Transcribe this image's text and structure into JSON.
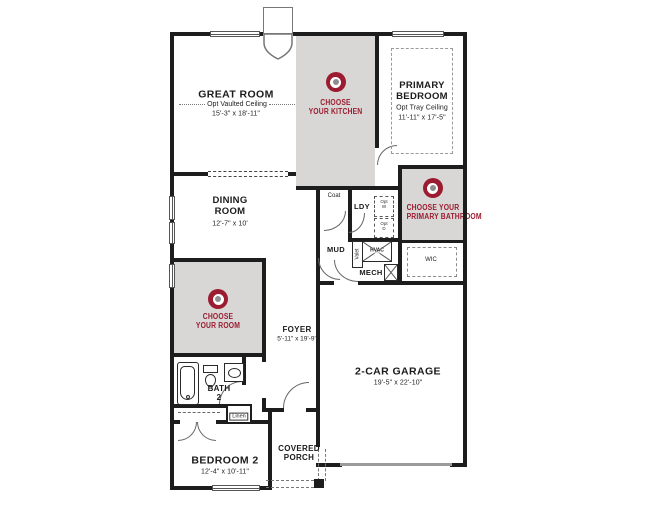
{
  "colors": {
    "accent_red": "#9b1c30",
    "room_highlight": "#d9d6d6",
    "wall": "#1d1d1d"
  },
  "rooms": {
    "great_room": {
      "name": "GREAT ROOM",
      "option": "Opt Vaulted Ceiling",
      "dims": "15'-3\" x 18'-11\""
    },
    "primary_bedroom": {
      "name_line1": "PRIMARY",
      "name_line2": "BEDROOM",
      "option": "Opt Tray Ceiling",
      "dims": "11'-11\" x 17'-5\""
    },
    "dining_room": {
      "name_line1": "DINING",
      "name_line2": "ROOM",
      "dims": "12'-7\" x 10'"
    },
    "foyer": {
      "name": "FOYER",
      "dims": "5'-11\" x 19'-9\""
    },
    "garage": {
      "name": "2-CAR GARAGE",
      "dims": "19'-5\" x 22'-10\""
    },
    "bedroom2": {
      "name": "BEDROOM 2",
      "dims": "12'-4\" x 10'-11\""
    },
    "bath2": {
      "name_line1": "BATH",
      "name_line2": "2"
    },
    "covered_porch": {
      "name_line1": "COVERED",
      "name_line2": "PORCH"
    },
    "wic": {
      "name": "WIC"
    },
    "ldy": {
      "name": "LDY"
    },
    "mud": {
      "name": "MUD"
    },
    "mech": {
      "name": "MECH"
    },
    "coat": {
      "name": "Coat"
    },
    "linen": {
      "name": "Linen"
    },
    "valet": {
      "name": "Valet"
    },
    "hvac": {
      "name": "HVAC"
    },
    "opt_washer": {
      "l1": "Opt",
      "l2": "W"
    },
    "opt_dryer": {
      "l1": "Opt",
      "l2": "D"
    }
  },
  "ctas": {
    "kitchen": {
      "line1": "CHOOSE",
      "line2": "YOUR KITCHEN"
    },
    "primary_bathroom": {
      "line1": "CHOOSE YOUR",
      "line2": "PRIMARY BATHROOM"
    },
    "flex_room": {
      "line1": "CHOOSE",
      "line2": "YOUR ROOM"
    }
  }
}
